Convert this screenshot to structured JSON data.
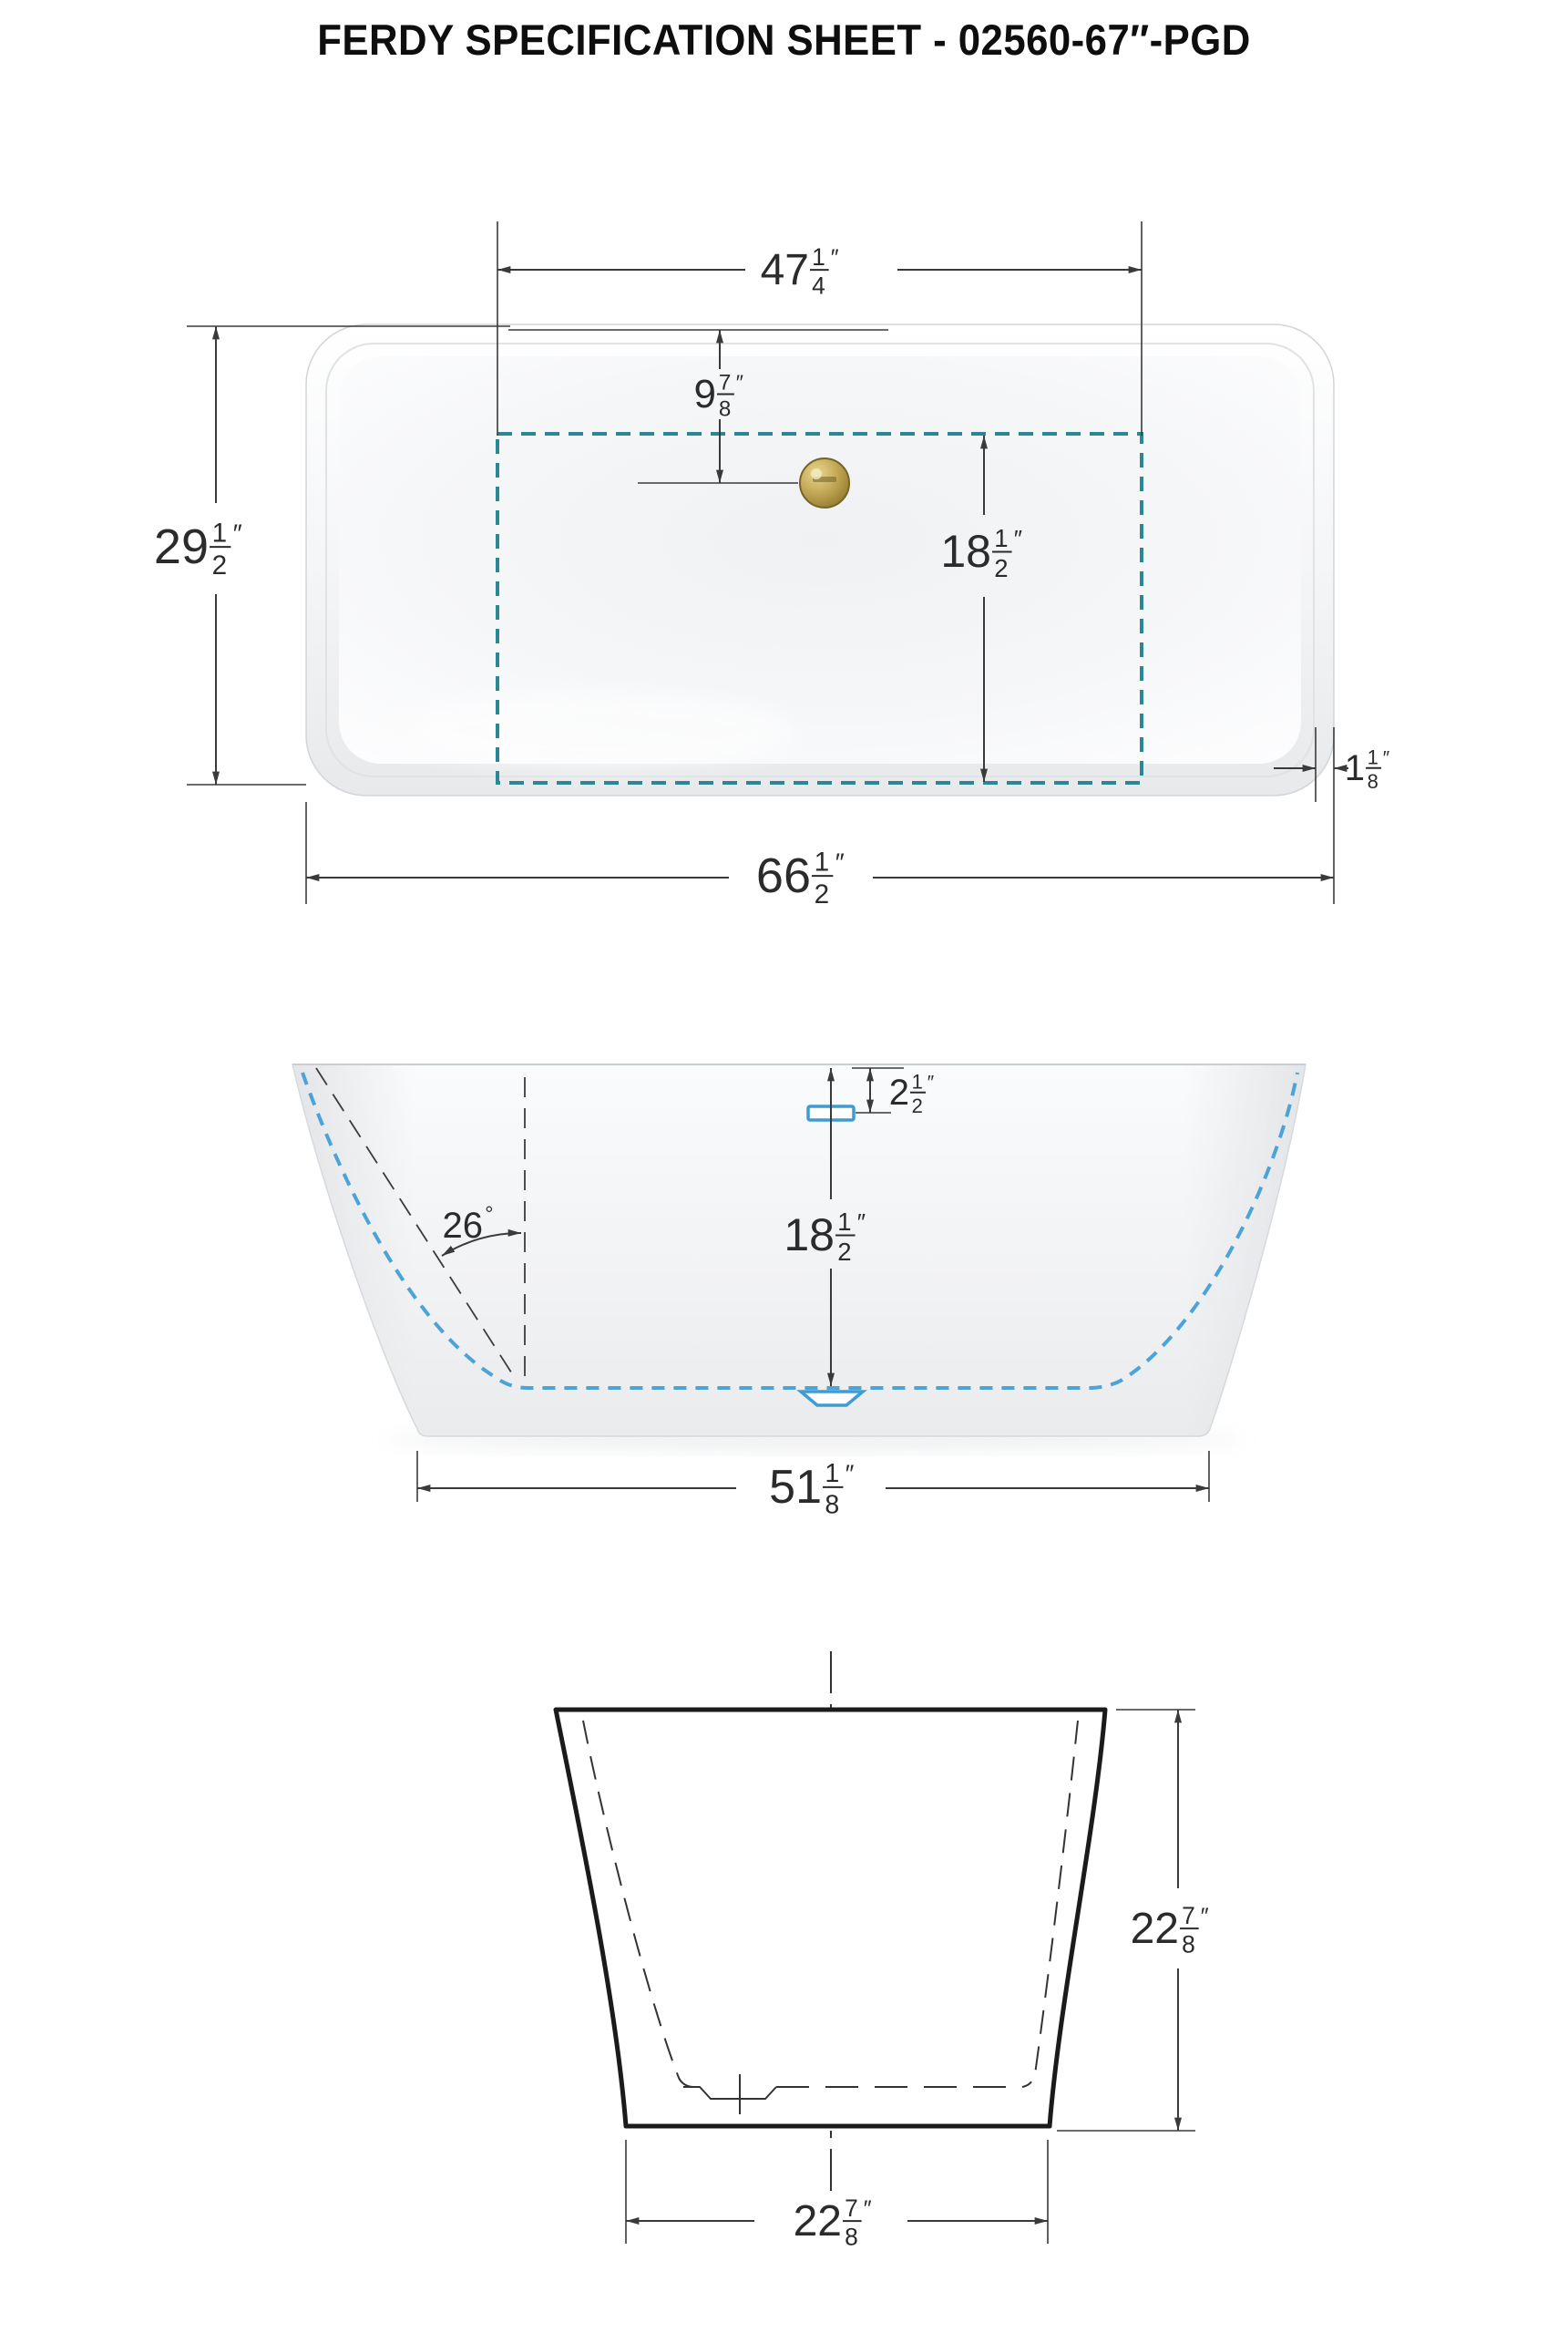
{
  "title": "FERDY SPECIFICATION SHEET - 02560-67″-PGD",
  "top_view": {
    "dims": {
      "inner_length": {
        "w": "47",
        "n": "1",
        "d": "4",
        "u": "″"
      },
      "drain_offset": {
        "w": "9",
        "n": "7",
        "d": "8",
        "u": "″"
      },
      "overall_width": {
        "w": "29",
        "n": "1",
        "d": "2",
        "u": "″"
      },
      "inner_width": {
        "w": "18",
        "n": "1",
        "d": "2",
        "u": "″"
      },
      "rim_thickness": {
        "w": "1",
        "n": "1",
        "d": "8",
        "u": "″"
      },
      "overall_length": {
        "w": "66",
        "n": "1",
        "d": "2",
        "u": "″"
      }
    }
  },
  "side_view": {
    "dims": {
      "overflow_drop": {
        "w": "2",
        "n": "1",
        "d": "2",
        "u": "″"
      },
      "wall_angle": {
        "w": "26",
        "u": "°"
      },
      "depth_to_drain": {
        "w": "18",
        "n": "1",
        "d": "2",
        "u": "″"
      },
      "base_length": {
        "w": "51",
        "n": "1",
        "d": "8",
        "u": "″"
      }
    }
  },
  "end_view": {
    "dims": {
      "overall_height": {
        "w": "22",
        "n": "7",
        "d": "8",
        "u": "″"
      },
      "base_width": {
        "w": "22",
        "n": "7",
        "d": "8",
        "u": "″"
      }
    }
  },
  "icons": {
    "drain_top": "gold-drain-circle",
    "overflow_side": "blue-overflow-rect",
    "drain_side": "blue-drain-trapezoid"
  },
  "colors": {
    "teal_dashed": "#2a8793",
    "blue_dashed": "#4ba3d8",
    "drain_gold": "#ab923d",
    "dim_line": "#3a3a3a",
    "outline_heavy": "#1b1b1b"
  }
}
